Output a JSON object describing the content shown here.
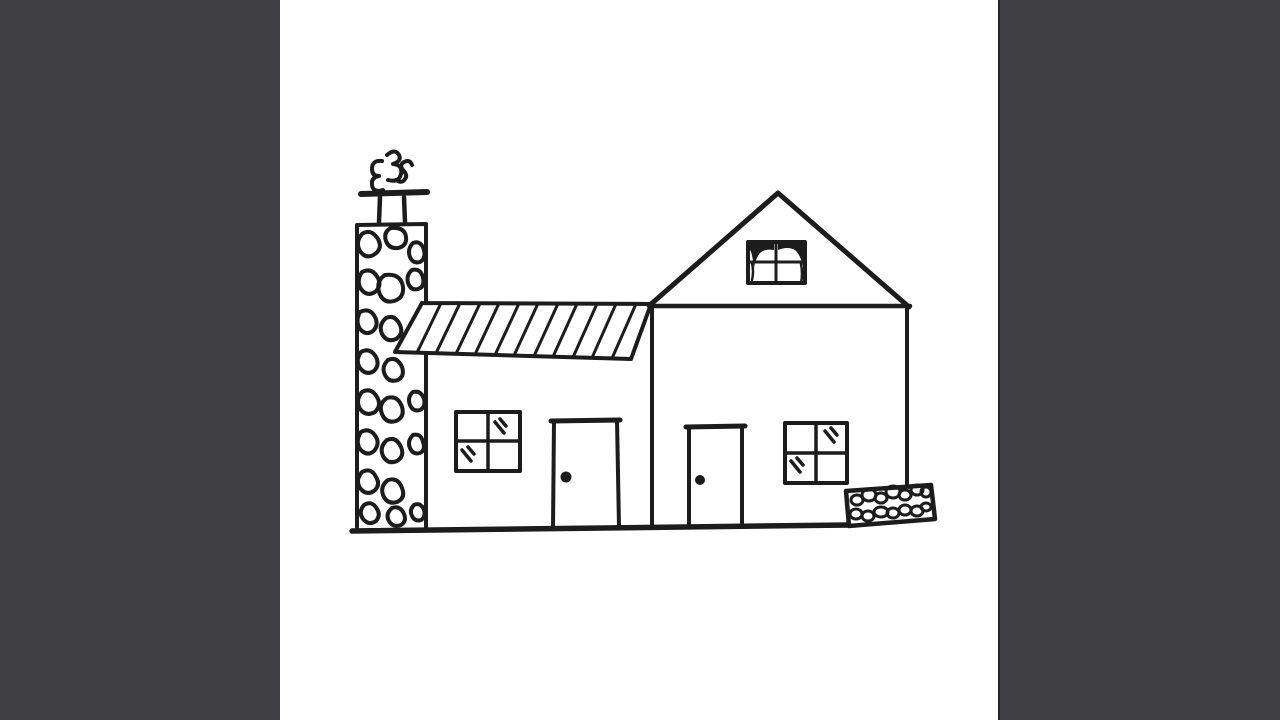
{
  "colors": {
    "ink": "#1c1c1c",
    "paper": "#ffffff",
    "letterbox": "#3f3f41",
    "letterbox_edge": "#262626"
  },
  "scene": {
    "aria_label": "Hand-drawn black ink sketch of a house on a white square, letterboxed by dark gray side bars",
    "subject": "doodle house sketch"
  },
  "elements": {
    "letterbox_left": "dark side bar",
    "letterbox_right": "dark side bar",
    "chimney": "stone chimney with flue and cap",
    "smoke": "three curly smoke puffs",
    "awning_roof": "slanted awning roof with diagonal hatching",
    "left_house": "left house section wall",
    "left_window": "four-pane window with glass shine marks",
    "left_door": "door with round knob",
    "right_house": "gabled house section",
    "gable_roof": "triangular gable roof",
    "attic_window": "attic window with dark curtains",
    "right_door": "door with round knob",
    "right_window": "four-pane window with glass shine marks",
    "ground": "ground baseline",
    "stone_bed": "low bed filled with pebbles"
  }
}
